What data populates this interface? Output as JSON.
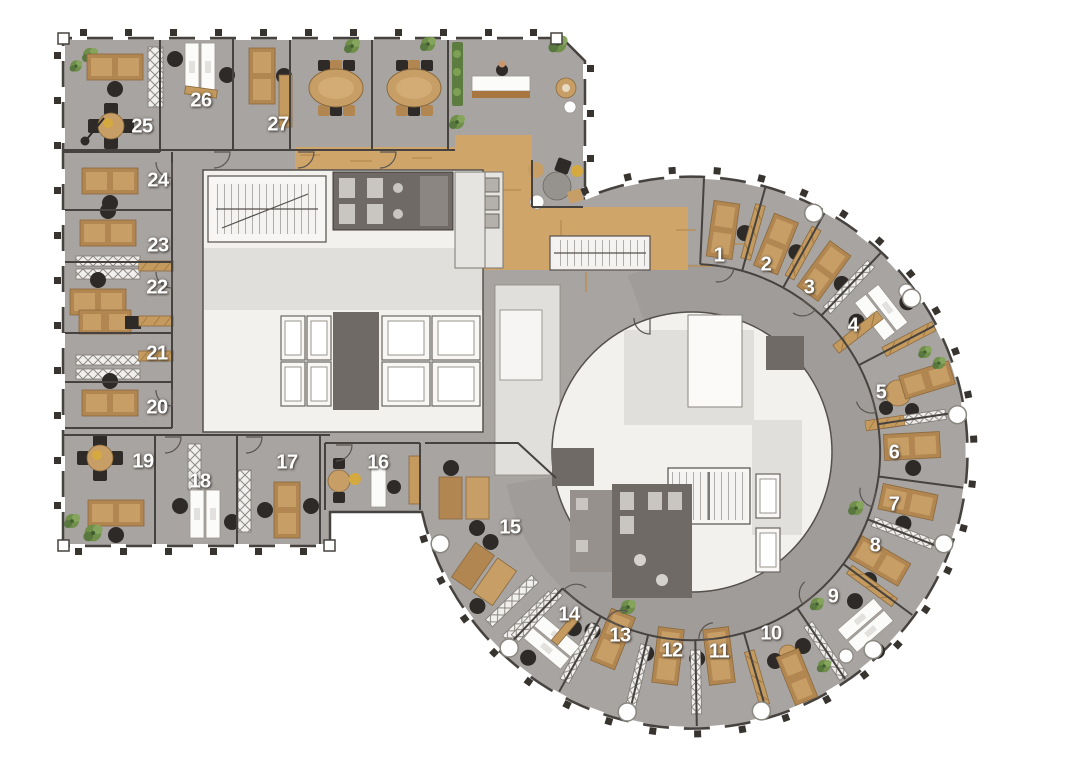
{
  "plan": {
    "type": "office-floor-plan",
    "wings": [
      "rectangular-wing",
      "circular-wing"
    ],
    "room_count": 27
  },
  "palette": {
    "office_floor": "#a8a4a1",
    "corridor": "#a09c99",
    "wood_floor": "#cfa56a",
    "walls": "#46423f",
    "core_white": "#f2f1ee",
    "core_light_gray": "#e1dfdb",
    "wet_rooms_dark": "#6f6a66",
    "desk_wood": "#b28650",
    "white_furniture": "#fbfbfa",
    "chairs": "#2d2a27",
    "plants": "#6f8f4a",
    "room_number_text": "#ffffff"
  },
  "rooms": [
    {
      "number": "1",
      "x": 719,
      "y": 256
    },
    {
      "number": "2",
      "x": 766,
      "y": 265
    },
    {
      "number": "3",
      "x": 809,
      "y": 288
    },
    {
      "number": "4",
      "x": 853,
      "y": 326
    },
    {
      "number": "5",
      "x": 881,
      "y": 393
    },
    {
      "number": "6",
      "x": 894,
      "y": 453
    },
    {
      "number": "7",
      "x": 894,
      "y": 505
    },
    {
      "number": "8",
      "x": 875,
      "y": 546
    },
    {
      "number": "9",
      "x": 833,
      "y": 597
    },
    {
      "number": "10",
      "x": 771,
      "y": 634
    },
    {
      "number": "11",
      "x": 719,
      "y": 652
    },
    {
      "number": "12",
      "x": 672,
      "y": 651
    },
    {
      "number": "13",
      "x": 620,
      "y": 636
    },
    {
      "number": "14",
      "x": 569,
      "y": 615
    },
    {
      "number": "15",
      "x": 510,
      "y": 528
    },
    {
      "number": "16",
      "x": 378,
      "y": 463
    },
    {
      "number": "17",
      "x": 287,
      "y": 463
    },
    {
      "number": "18",
      "x": 200,
      "y": 482
    },
    {
      "number": "19",
      "x": 143,
      "y": 462
    },
    {
      "number": "20",
      "x": 157,
      "y": 408
    },
    {
      "number": "21",
      "x": 157,
      "y": 354
    },
    {
      "number": "22",
      "x": 157,
      "y": 288
    },
    {
      "number": "23",
      "x": 158,
      "y": 246
    },
    {
      "number": "24",
      "x": 158,
      "y": 181
    },
    {
      "number": "25",
      "x": 142,
      "y": 127
    },
    {
      "number": "26",
      "x": 201,
      "y": 101
    },
    {
      "number": "27",
      "x": 278,
      "y": 125
    }
  ]
}
